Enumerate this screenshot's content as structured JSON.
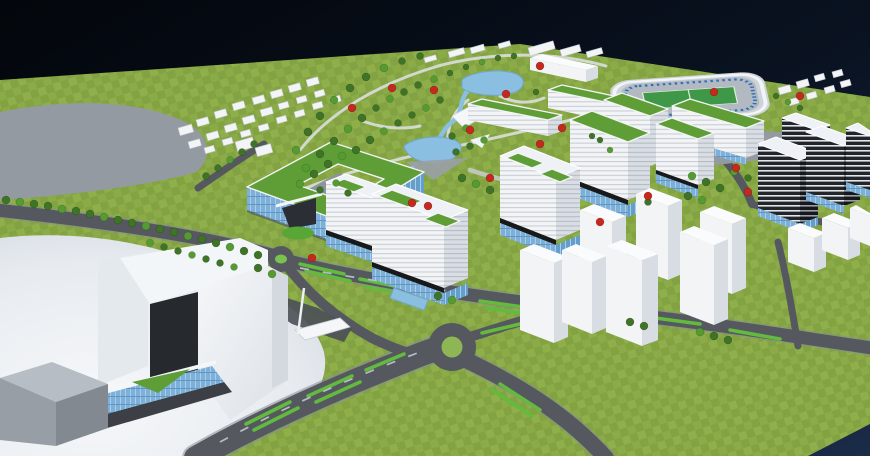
{
  "meta": {
    "title": "Aerial 3D masterplan render of a mixed-use urban campus",
    "view": "bird's-eye perspective on dark navy backdrop"
  },
  "palette": {
    "sky-top": "#04070d",
    "sky-bottom": "#16263f",
    "grass": "#8aab47",
    "grass-dark": "#7b9a3d",
    "grass-light": "#96b652",
    "road": "#55595f",
    "plaza-grey": "#939aa1",
    "plaza-white": "#eef1f5",
    "building-lit": "#f2f4f6",
    "building-shade": "#d8dde3",
    "green-roof": "#5f9e36",
    "black-band": "#17191d",
    "blue-glass": "#7cb0d8",
    "blue-glass-hi": "#aacdea",
    "blue-glass-lo": "#5d93bf",
    "blue-glass-sh": "#649ecb",
    "rib-bg": "#f2f4f6",
    "rib-line": "#c9ced5",
    "rib-bg-sh": "#d9dee4",
    "rib-line-sh": "#b5bbc3",
    "dark-bg": "#22252a",
    "dark-line": "#e2e6ea",
    "dark-bg-sh": "#15171c",
    "dark-line-sh": "#9aa0a7",
    "water": "#8abfe2",
    "water-deep": "#6fa9d2",
    "tree-green": "#3f7326",
    "tree-green-light": "#569b31",
    "tree-red": "#c5281c",
    "pitch-green": "#3f9848",
    "seat-blue": "#2f6fc0",
    "median-green": "#63bb3e",
    "path-light": "#d9dedb",
    "shadow": "#3a3e44"
  },
  "scene": {
    "elements": [
      "sky",
      "grass-terrain",
      "central-park",
      "upper-lake",
      "lower-lake",
      "stream",
      "stadium",
      "courtyard-ring-building",
      "office-towers-green-roof",
      "slab-buildings",
      "dark-striped-towers",
      "residential-cross-towers",
      "low-rise-housing",
      "grand-arch-building",
      "curved-white-plaza",
      "northwest-grey-plaza",
      "boulevard",
      "roundabout",
      "mini-roundabout",
      "glass-podiums",
      "tree-rows",
      "red-accent-trees",
      "park-pavilion",
      "entry-canopy"
    ],
    "trees": {
      "green": [
        [
          6,
          200,
          4
        ],
        [
          20,
          202,
          4
        ],
        [
          34,
          204,
          4
        ],
        [
          48,
          206,
          4
        ],
        [
          62,
          209,
          4
        ],
        [
          76,
          211,
          4
        ],
        [
          90,
          214,
          4
        ],
        [
          104,
          217,
          4
        ],
        [
          118,
          220,
          4
        ],
        [
          132,
          223,
          4
        ],
        [
          146,
          226,
          4
        ],
        [
          160,
          229,
          4
        ],
        [
          174,
          232,
          4
        ],
        [
          188,
          236,
          4
        ],
        [
          202,
          239,
          4
        ],
        [
          216,
          243,
          4
        ],
        [
          230,
          247,
          4
        ],
        [
          244,
          251,
          4
        ],
        [
          258,
          255,
          4
        ],
        [
          150,
          243,
          3.5
        ],
        [
          164,
          247,
          3.5
        ],
        [
          178,
          251,
          3.5
        ],
        [
          192,
          255,
          3.5
        ],
        [
          206,
          259,
          3.5
        ],
        [
          220,
          263,
          3.5
        ],
        [
          234,
          267,
          3.5
        ],
        [
          206,
          176,
          3.5
        ],
        [
          218,
          168,
          3.5
        ],
        [
          230,
          160,
          3.5
        ],
        [
          242,
          152,
          3.5
        ],
        [
          254,
          144,
          3.5
        ],
        [
          296,
          150,
          4
        ],
        [
          308,
          132,
          4
        ],
        [
          320,
          116,
          4
        ],
        [
          334,
          100,
          4
        ],
        [
          350,
          88,
          4
        ],
        [
          366,
          77,
          4
        ],
        [
          384,
          68,
          4
        ],
        [
          402,
          61,
          3.5
        ],
        [
          420,
          56,
          3.5
        ],
        [
          306,
          168,
          4
        ],
        [
          320,
          154,
          4
        ],
        [
          334,
          141,
          4
        ],
        [
          348,
          129,
          4
        ],
        [
          362,
          118,
          4
        ],
        [
          376,
          108,
          3.5
        ],
        [
          390,
          99,
          3.5
        ],
        [
          404,
          92,
          3.5
        ],
        [
          418,
          85,
          3.5
        ],
        [
          434,
          79,
          3.5
        ],
        [
          450,
          73,
          3
        ],
        [
          466,
          67,
          3
        ],
        [
          482,
          62,
          3
        ],
        [
          498,
          58,
          3
        ],
        [
          514,
          56,
          3
        ],
        [
          300,
          184,
          4
        ],
        [
          314,
          174,
          4
        ],
        [
          328,
          164,
          4
        ],
        [
          342,
          156,
          4
        ],
        [
          356,
          150,
          4
        ],
        [
          370,
          140,
          4
        ],
        [
          384,
          131,
          3.5
        ],
        [
          398,
          123,
          3.5
        ],
        [
          412,
          115,
          3.5
        ],
        [
          426,
          108,
          3.5
        ],
        [
          440,
          100,
          3.5
        ],
        [
          452,
          136,
          3.5
        ],
        [
          466,
          128,
          3.5
        ],
        [
          456,
          152,
          3.5
        ],
        [
          470,
          146,
          3.5
        ],
        [
          484,
          140,
          3.5
        ],
        [
          536,
          92,
          3
        ],
        [
          462,
          178,
          4
        ],
        [
          476,
          184,
          4
        ],
        [
          490,
          190,
          4
        ],
        [
          438,
          296,
          4
        ],
        [
          452,
          300,
          4
        ],
        [
          630,
          322,
          4
        ],
        [
          644,
          326,
          4
        ],
        [
          700,
          332,
          4
        ],
        [
          714,
          336,
          4
        ],
        [
          728,
          340,
          4
        ],
        [
          692,
          176,
          4
        ],
        [
          706,
          182,
          4
        ],
        [
          720,
          188,
          4
        ],
        [
          734,
          172,
          3.5
        ],
        [
          748,
          178,
          3.5
        ],
        [
          688,
          196,
          4
        ],
        [
          702,
          200,
          4
        ],
        [
          648,
          202,
          3.5
        ],
        [
          776,
          96,
          3
        ],
        [
          788,
          102,
          3
        ],
        [
          800,
          108,
          3
        ],
        [
          320,
          190,
          3.5
        ],
        [
          336,
          183,
          3.5
        ],
        [
          348,
          193,
          3.5
        ],
        [
          258,
          268,
          4
        ],
        [
          272,
          274,
          4
        ],
        [
          592,
          136,
          3
        ],
        [
          600,
          140,
          3
        ],
        [
          610,
          150,
          3
        ]
      ],
      "red": [
        [
          352,
          108,
          4
        ],
        [
          392,
          88,
          4
        ],
        [
          434,
          90,
          4
        ],
        [
          470,
          130,
          4
        ],
        [
          506,
          94,
          4
        ],
        [
          540,
          66,
          4
        ],
        [
          562,
          128,
          4
        ],
        [
          600,
          222,
          4
        ],
        [
          490,
          178,
          4
        ],
        [
          428,
          206,
          4
        ],
        [
          412,
          203,
          4
        ],
        [
          312,
          258,
          4
        ],
        [
          736,
          168,
          4
        ],
        [
          748,
          192,
          4
        ],
        [
          800,
          96,
          4
        ],
        [
          540,
          144,
          4
        ],
        [
          714,
          92,
          4
        ],
        [
          648,
          196,
          4
        ]
      ]
    },
    "houses": {
      "cluster_nw": [
        [
          178,
          128,
          14,
          8
        ],
        [
          196,
          120,
          12,
          7
        ],
        [
          214,
          112,
          12,
          7
        ],
        [
          232,
          104,
          12,
          7
        ],
        [
          252,
          98,
          12,
          7
        ],
        [
          270,
          92,
          12,
          7
        ],
        [
          288,
          86,
          12,
          7
        ],
        [
          306,
          80,
          12,
          7
        ],
        [
          188,
          142,
          12,
          7
        ],
        [
          206,
          134,
          12,
          7
        ],
        [
          224,
          126,
          12,
          7
        ],
        [
          242,
          118,
          12,
          7
        ],
        [
          260,
          110,
          12,
          7
        ],
        [
          278,
          104,
          10,
          6
        ],
        [
          296,
          98,
          10,
          6
        ],
        [
          314,
          92,
          10,
          6
        ],
        [
          204,
          148,
          10,
          6
        ],
        [
          222,
          140,
          10,
          6
        ],
        [
          240,
          132,
          10,
          6
        ],
        [
          258,
          126,
          10,
          6
        ],
        [
          276,
          118,
          10,
          6
        ],
        [
          294,
          112,
          10,
          6
        ],
        [
          312,
          104,
          10,
          6
        ],
        [
          330,
          98,
          10,
          6
        ],
        [
          235,
          142,
          18,
          10
        ],
        [
          255,
          148,
          16,
          9
        ]
      ],
      "cluster_e": [
        [
          778,
          88,
          12,
          7
        ],
        [
          796,
          82,
          12,
          7
        ],
        [
          814,
          76,
          10,
          6
        ],
        [
          832,
          72,
          10,
          6
        ],
        [
          788,
          100,
          10,
          6
        ],
        [
          806,
          94,
          10,
          6
        ],
        [
          824,
          88,
          10,
          6
        ],
        [
          840,
          82,
          10,
          6
        ]
      ],
      "cluster_n": [
        [
          528,
          48,
          26,
          8
        ],
        [
          560,
          50,
          20,
          7
        ],
        [
          586,
          52,
          16,
          6
        ],
        [
          448,
          52,
          16,
          6
        ],
        [
          470,
          48,
          14,
          6
        ],
        [
          424,
          58,
          12,
          5
        ],
        [
          498,
          44,
          12,
          5
        ]
      ]
    }
  }
}
